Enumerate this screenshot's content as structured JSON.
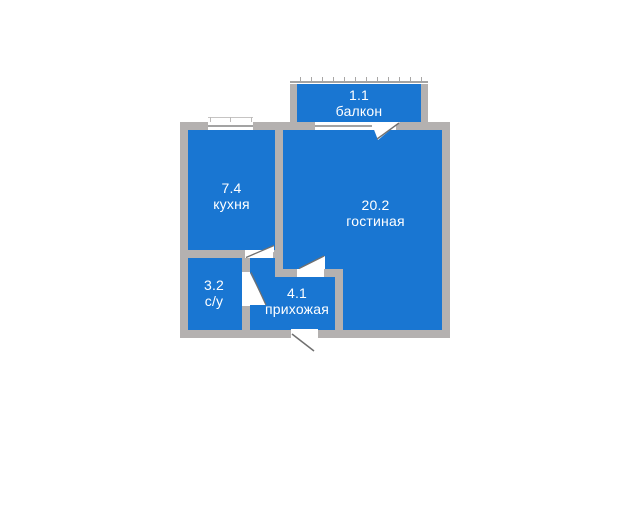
{
  "floorplan": {
    "rooms": {
      "balcony": {
        "area": "1.1",
        "name": "балкон"
      },
      "kitchen": {
        "area": "7.4",
        "name": "кухня"
      },
      "living": {
        "area": "20.2",
        "name": "гостиная"
      },
      "bathroom": {
        "area": "3.2",
        "name": "с/у"
      },
      "hallway": {
        "area": "4.1",
        "name": "прихожая"
      }
    },
    "colors": {
      "room_fill": "#1976d2",
      "wall": "#b4b1b0",
      "label": "#ffffff",
      "background": "#ffffff",
      "glass_line": "#a3a3a3",
      "door_line": "#707070"
    }
  }
}
